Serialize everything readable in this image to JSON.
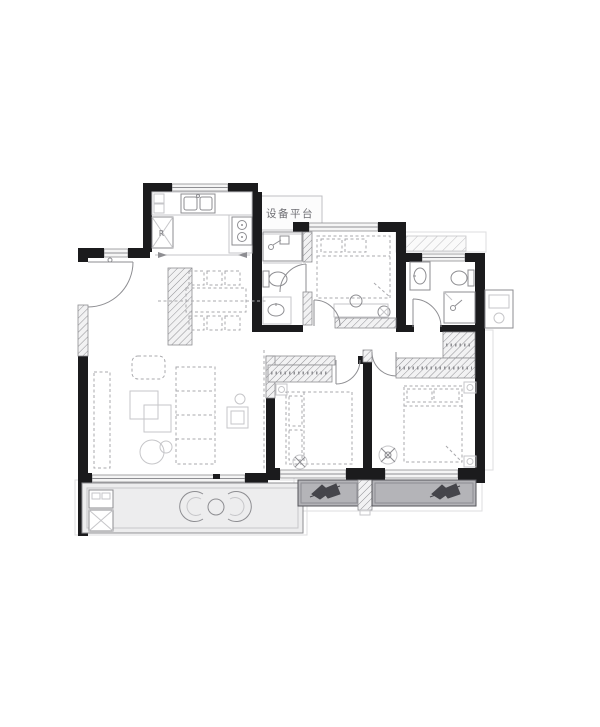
{
  "floor_plan": {
    "labels": {
      "equipment_platform": "设备平台",
      "refrigerator": "R"
    },
    "colors": {
      "paper": "#ffffff",
      "wall": "#1b1b1d",
      "line": "#8e8e92",
      "light_line": "#c6c6c9",
      "dash": "#a9a9ad",
      "hatch": "#8f8f93",
      "window_fill": "#f5f5f5",
      "balcony_fill": "#ededee",
      "planter_fill": "#b4b4b8",
      "planter_line": "#55555a"
    }
  }
}
